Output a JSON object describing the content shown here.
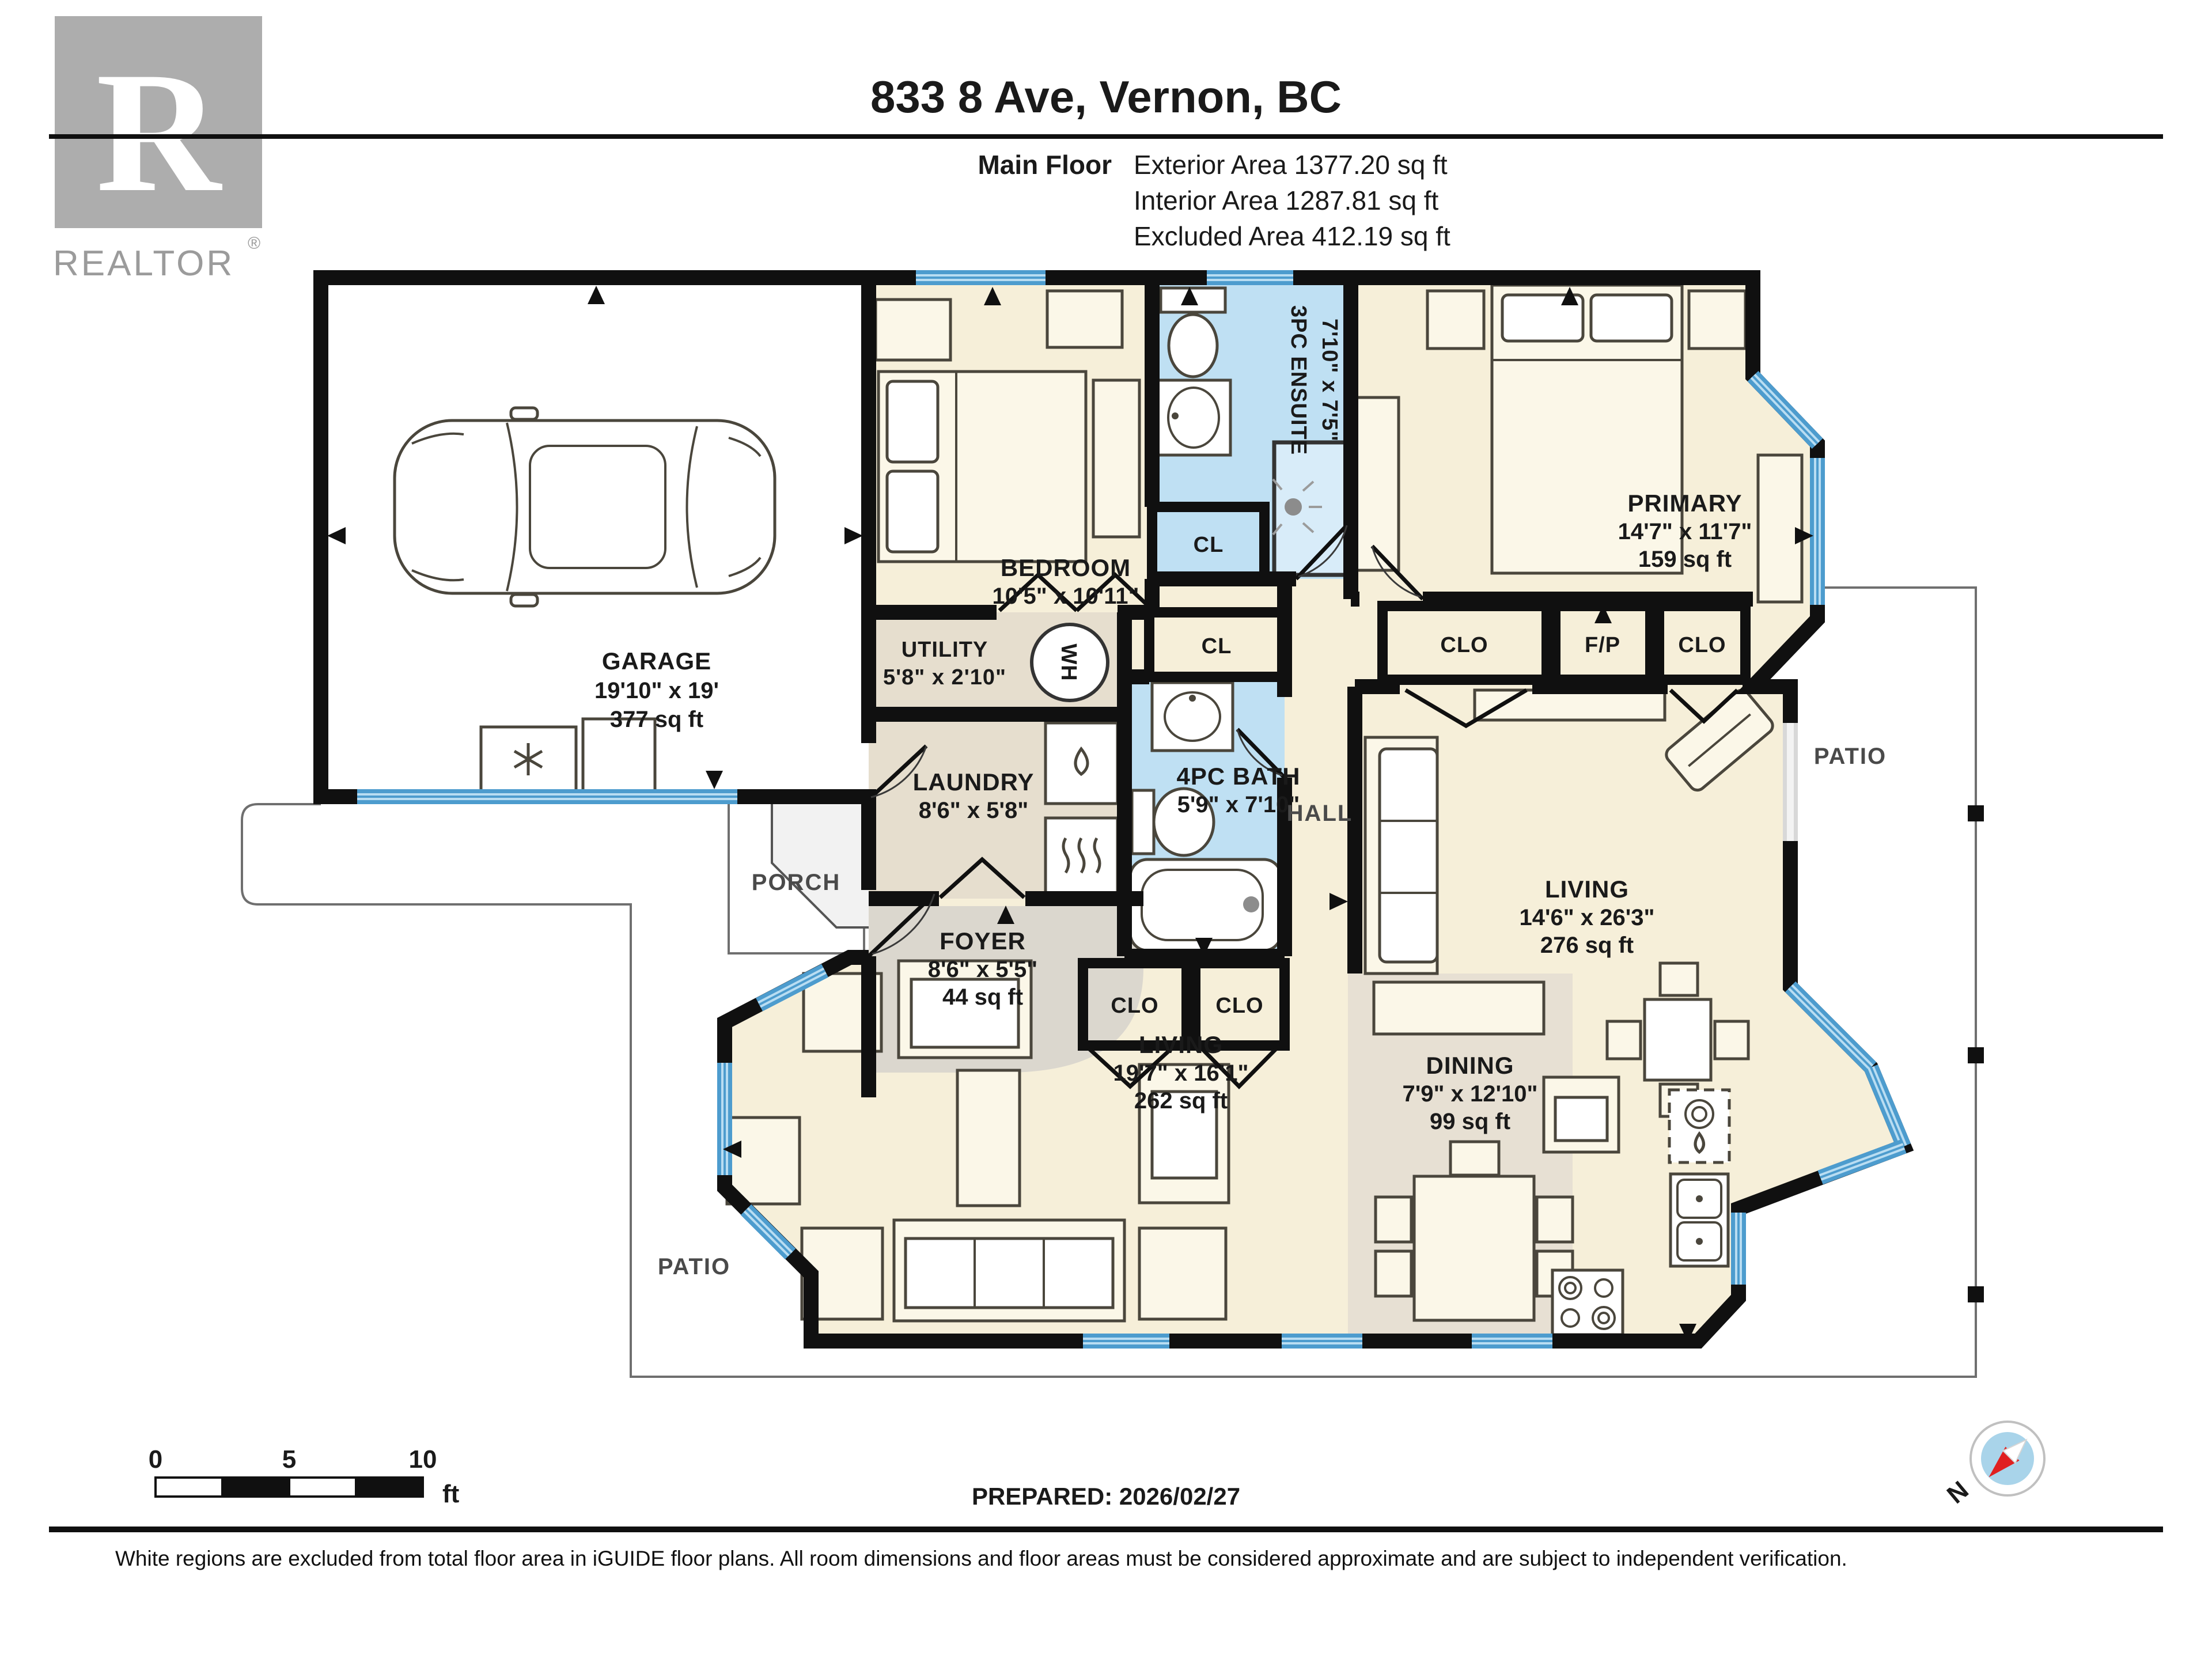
{
  "header": {
    "title": "833 8 Ave, Vernon, BC",
    "floor_label": "Main Floor",
    "exterior_area": "Exterior Area 1377.20 sq ft",
    "interior_area": "Interior Area 1287.81 sq ft",
    "excluded_area": "Excluded Area 412.19 sq ft",
    "logo_word": "REALTOR",
    "logo_reg": "®",
    "logo_letter": "R"
  },
  "rooms": {
    "garage": {
      "name": "GARAGE",
      "dims": "19'10\" x 19'",
      "area": "377 sq ft"
    },
    "bedroom": {
      "name": "BEDROOM",
      "dims": "10'5\" x 10'11\""
    },
    "ensuite": {
      "name": "3PC ENSUITE",
      "dims": "7'10\" x 7'5\""
    },
    "primary": {
      "name": "PRIMARY",
      "dims": "14'7\" x 11'7\"",
      "area": "159 sq ft"
    },
    "utility": {
      "name": "UTILITY",
      "dims": "5'8\" x 2'10\""
    },
    "laundry": {
      "name": "LAUNDRY",
      "dims": "8'6\" x 5'8\""
    },
    "bath": {
      "name": "4PC BATH",
      "dims": "5'9\" x 7'10\""
    },
    "hall": {
      "name": "HALL"
    },
    "foyer": {
      "name": "FOYER",
      "dims": "8'6\" x 5'5\"",
      "area": "44 sq ft"
    },
    "porch": {
      "name": "PORCH"
    },
    "living_right": {
      "name": "LIVING",
      "dims": "14'6\" x 26'3\"",
      "area": "276 sq ft"
    },
    "living_left": {
      "name": "LIVING",
      "dims": "19'7\" x 16'1\"",
      "area": "262 sq ft"
    },
    "dining": {
      "name": "DINING",
      "dims": "7'9\" x 12'10\"",
      "area": "99 sq ft"
    },
    "patio_right": {
      "name": "PATIO"
    },
    "patio_left": {
      "name": "PATIO"
    },
    "closet_upper": "CL",
    "closet_lower": "CL",
    "clo_hall_left": "CLO",
    "clo_hall_right": "CLO",
    "clo_primary_left": "CLO",
    "clo_primary_right": "CLO",
    "fireplace": "F/P",
    "water_heater": "WH"
  },
  "footer": {
    "prepared": "PREPARED: 2026/02/27",
    "scale_0": "0",
    "scale_5": "5",
    "scale_10": "10",
    "scale_unit": "ft",
    "compass_north": "N",
    "disclaimer": "White regions are excluded from total floor area in iGUIDE floor plans. All room dimensions and floor areas must be considered approximate and are subject to independent verification."
  },
  "colors": {
    "room_beige": "#F6EFD9",
    "room_gray": "#E6DECE",
    "foyer_gray": "#DBD7CE",
    "bath_blue": "#BFE0F3",
    "window_blue": "#4D9CCE",
    "wall_black": "#101010",
    "compass_red": "#E02020"
  }
}
